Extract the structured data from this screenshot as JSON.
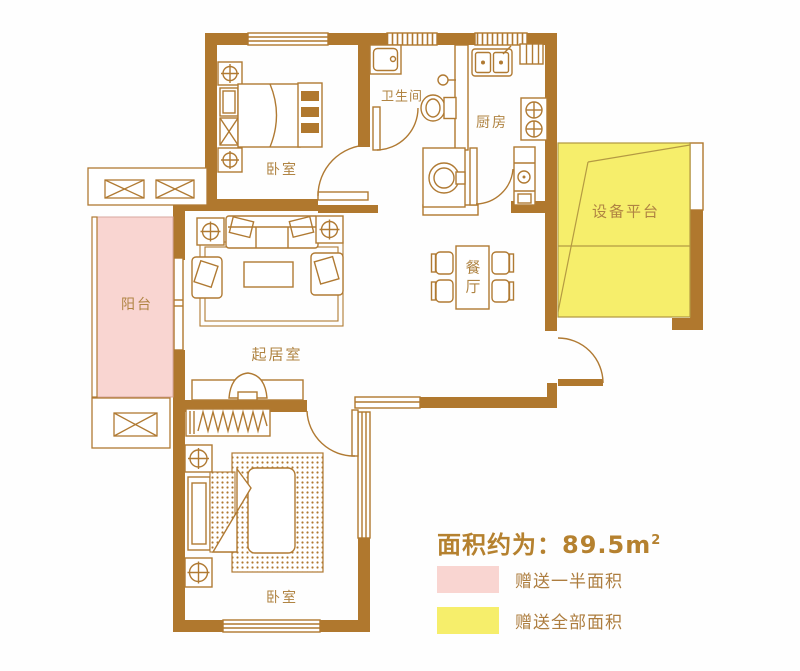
{
  "rooms": {
    "bedroom_top": {
      "label": "卧室"
    },
    "bathroom": {
      "label": "卫生间"
    },
    "kitchen": {
      "label": "厨房"
    },
    "equipment_platform": {
      "label": "设备平台"
    },
    "balcony": {
      "label": "阳台"
    },
    "living_room": {
      "label": "起居室"
    },
    "dining_room": {
      "label": "餐厅"
    },
    "bedroom_bottom": {
      "label": "卧室"
    }
  },
  "legend": {
    "area_prefix": "面积约为：",
    "area_value": "89.5m",
    "area_exponent": "2",
    "items": [
      {
        "swatch_color": "#f9d5d1",
        "label": "赠送一半面积"
      },
      {
        "swatch_color": "#f6ee6b",
        "label": "赠送全部面积"
      }
    ]
  },
  "colors": {
    "wall": "#b0782e",
    "outline": "#b07a33",
    "balcony_fill": "#f9d5d1",
    "platform_fill": "#f6ee6b",
    "label_text": "#b08443",
    "title_text": "#b5812f",
    "background": "#fefefe"
  }
}
